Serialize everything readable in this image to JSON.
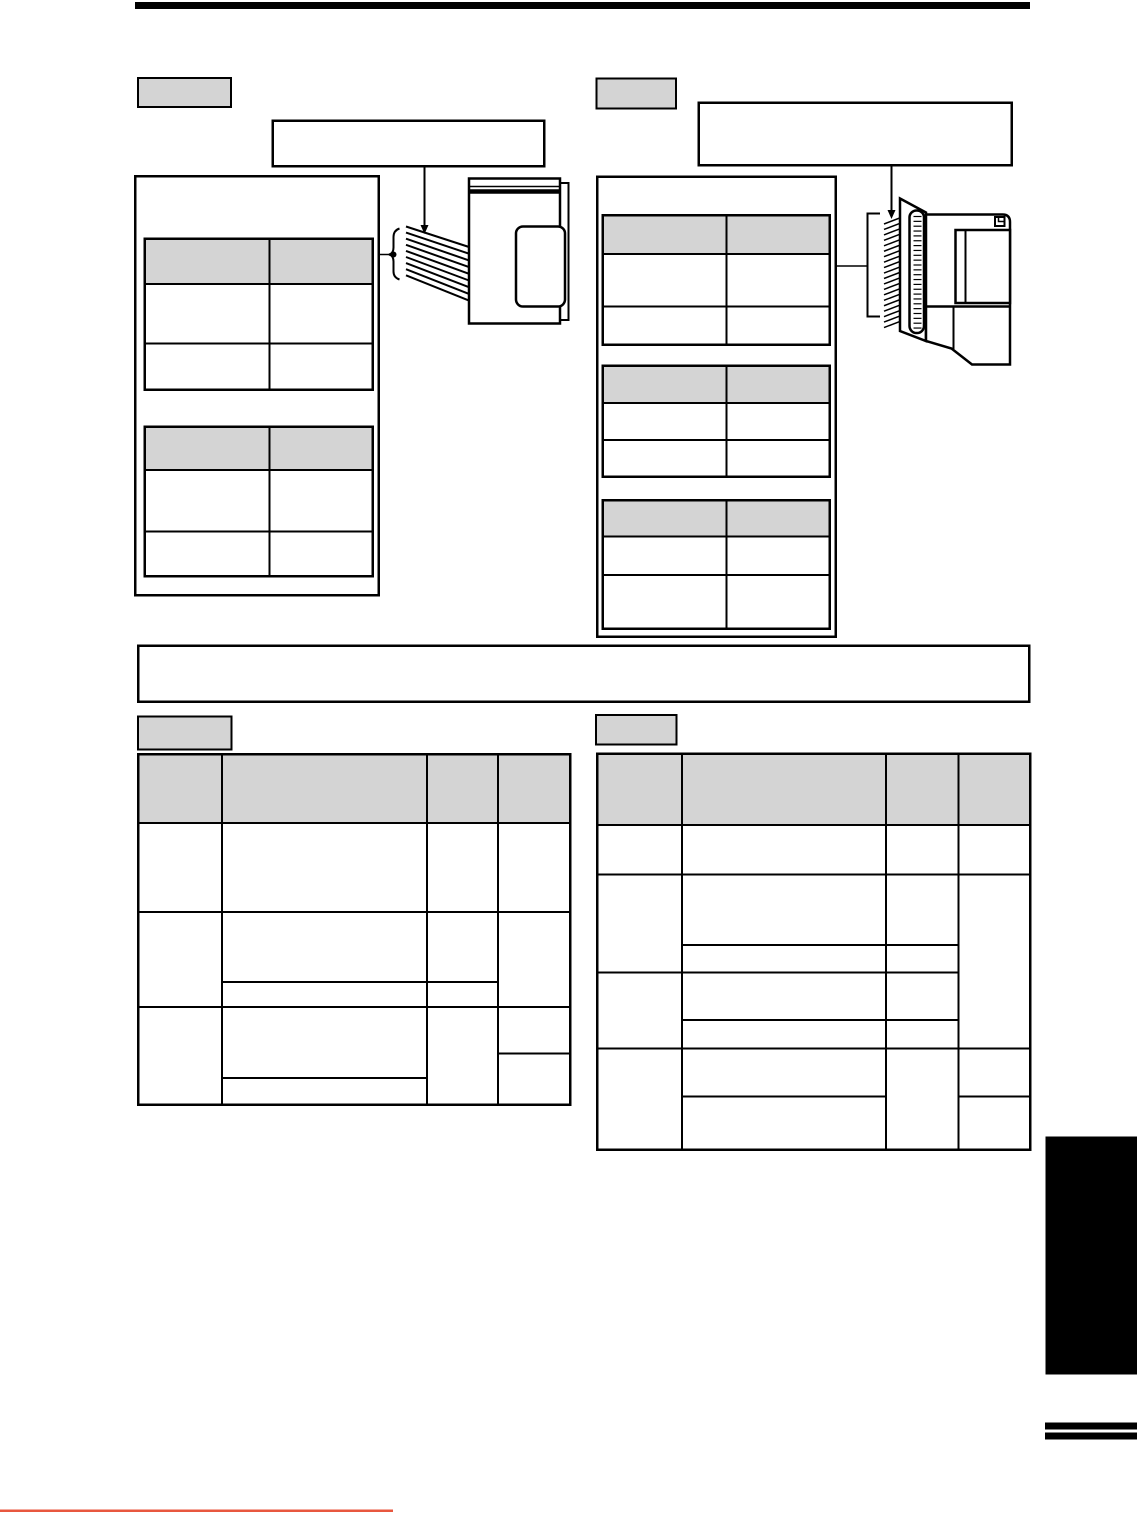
{
  "page": {
    "kind": "technical-manual-page",
    "visible_text": "",
    "note": "page renders as line-art template only; no glyph text is visible in the pixels"
  },
  "colors": {
    "ink": "#000000",
    "gray": "#d4d4d4",
    "red": "#e8573f",
    "paper": "#ffffff"
  },
  "figures": {
    "left_cable": {
      "line_count": 9
    },
    "right_pins": {
      "line_count": 20
    },
    "right_slot_hatch": {
      "line_count": 24
    }
  },
  "tables": {
    "left_panel_tables": [
      {
        "cols": 2,
        "rows": 3,
        "header_rows": 1,
        "cells": "empty"
      },
      {
        "cols": 2,
        "rows": 3,
        "header_rows": 1,
        "cells": "empty"
      }
    ],
    "right_panel_tables": [
      {
        "cols": 2,
        "rows": 3,
        "header_rows": 1,
        "cells": "empty"
      },
      {
        "cols": 2,
        "rows": 3,
        "header_rows": 1,
        "cells": "empty"
      },
      {
        "cols": 2,
        "rows": 3,
        "header_rows": 1,
        "cells": "empty"
      }
    ],
    "bottom_left_table": {
      "cols": 4,
      "header_rows": 1,
      "body_rows": 3,
      "cells": "empty"
    },
    "bottom_right_table": {
      "cols": 4,
      "header_rows": 1,
      "body_rows": 4,
      "cells": "empty"
    }
  }
}
